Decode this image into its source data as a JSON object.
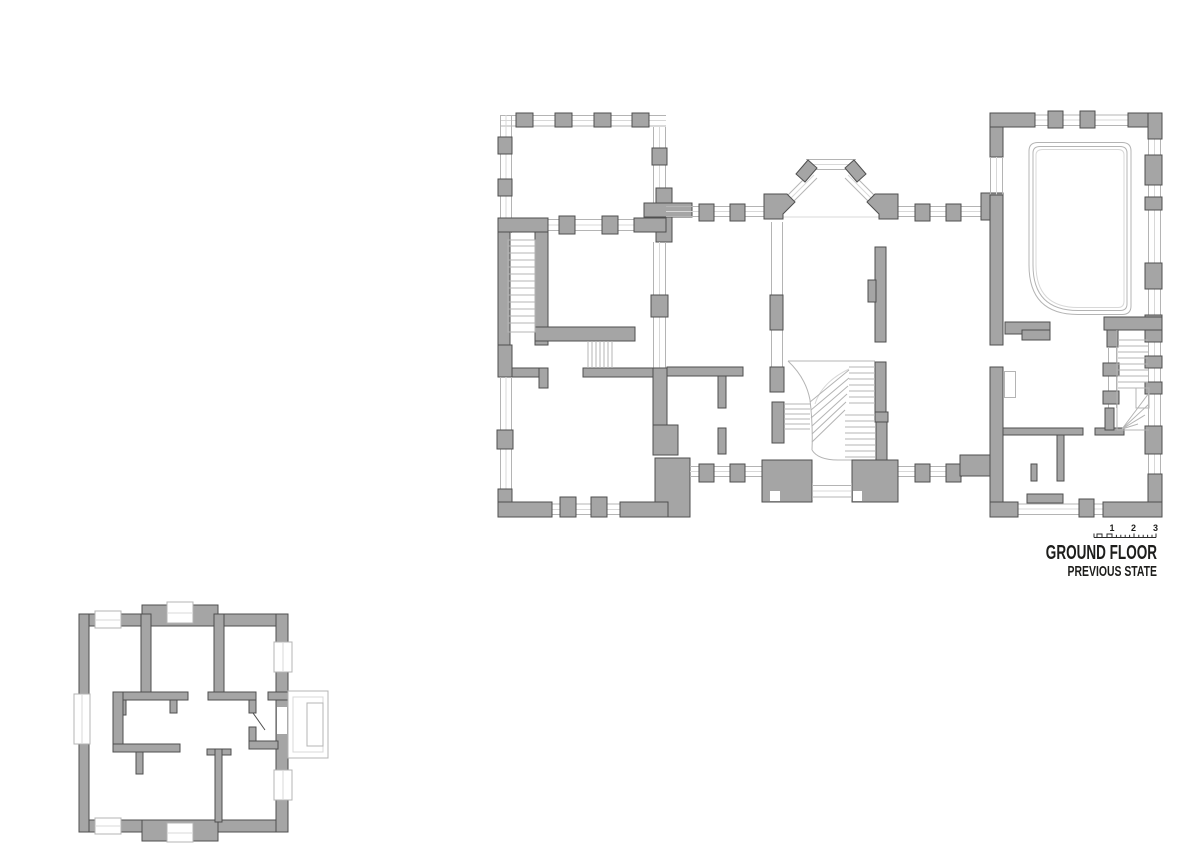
{
  "title": {
    "main": "GROUND FLOOR",
    "sub": "PREVIOUS STATE"
  },
  "scale_bar": {
    "labels": [
      "1",
      "2",
      "3"
    ]
  },
  "colors": {
    "background": "#ffffff",
    "wall-fill": "#a5a5a5",
    "wall-stroke": "#4f4f4f",
    "line": "#b4b4b4",
    "line-light": "#d8d8d8",
    "text": "#1d1d1b",
    "scale-stroke": "#2b2b2b"
  }
}
